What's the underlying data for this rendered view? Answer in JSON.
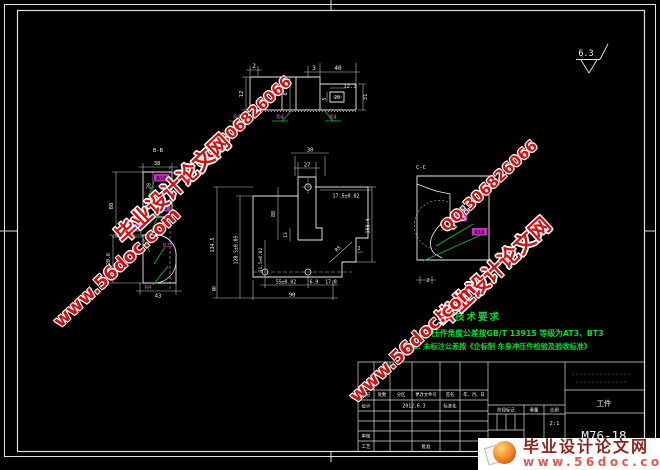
{
  "surface_finish": "6.3",
  "tech": {
    "title": "技术要求",
    "item1": "1. 冲压件角度公差按GB/T 13915 等级为AT3、BT3",
    "item2": "2. 未标注公差按《企标制 车身冲压件检验及验收标准》"
  },
  "watermark": {
    "site": "毕业设计论文网",
    "qq": "QQ:306826066",
    "url": "www.56doc.com"
  },
  "banner": {
    "title": "毕业设计论文网",
    "url": "www.56doc.com"
  },
  "title_block": {
    "headers": [
      "标记",
      "处数",
      "分区",
      "更改文件号",
      "签名",
      "年、月、日"
    ],
    "design": "设计",
    "date": "2012.6.3",
    "standardize": "标准化",
    "check": "审核",
    "process": "工艺",
    "approve": "批准",
    "stage": "阶段标记",
    "weight": "重量",
    "scale_label": "比例",
    "scale": "2:1",
    "part_name": "工件",
    "drawing_no": "M76-18"
  },
  "views": {
    "top": {
      "d_2": "2",
      "d_3": "3",
      "d_40": "40",
      "d_12_3": "12.3",
      "d_20": "20",
      "d_5": "5",
      "d_31": "31",
      "d_12": "12",
      "d_8": "8",
      "r4_1": "R4",
      "r4_2": "R4",
      "r4_3": "R4"
    },
    "section_b": {
      "label": "B-B",
      "d_38": "38",
      "d_28": "28",
      "d_88": "88",
      "d_20_6": "20.6",
      "d_43": "43",
      "r10": "R10",
      "r5": "R5",
      "r2": "R2",
      "r25": "R25",
      "r4": "R4"
    },
    "front": {
      "d_30": "30",
      "d_27": "27",
      "d_17_5": "17.5±0.02",
      "d_108_4": "108.4",
      "d_134_5": "134.5",
      "d_128_5": "128.5±0.05",
      "d_88": "88",
      "d_13": "13",
      "d_11_5": "11.5±0.02",
      "d_55": "55±0.02",
      "d_6_9": "6.9",
      "d_17_8": "17.8",
      "d_90": "90",
      "b_label": "B",
      "r5": "R5",
      "d_2": "2"
    },
    "section_c": {
      "label": "C-C",
      "r2": "R2",
      "r10": "R10",
      "d_2": "2"
    }
  }
}
